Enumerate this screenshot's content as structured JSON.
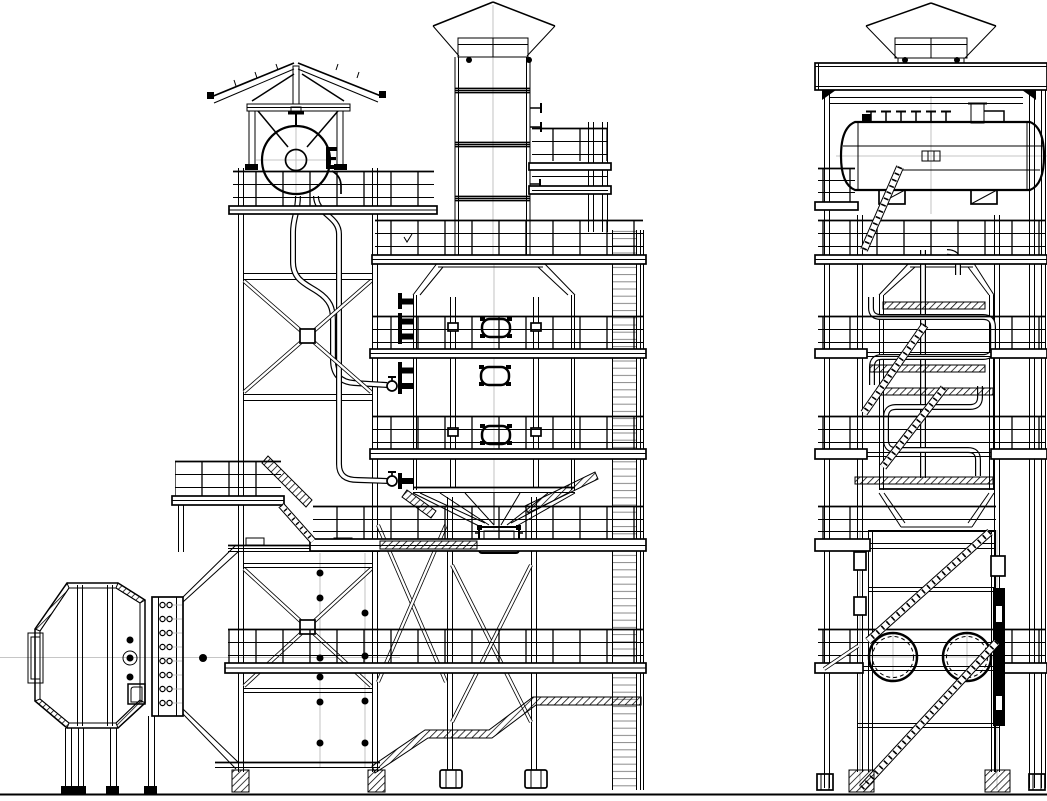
{
  "document": {
    "kind": "technical line drawing",
    "subject": "boiler / flue-gas cleaning tower general arrangement",
    "views": [
      "front elevation",
      "side elevation"
    ],
    "background_color": "#ffffff",
    "line_color": "#000000",
    "centerline_color": "#b4b4b4"
  },
  "front_elevation": {
    "components": [
      "gabled drum shelter with king-post truss",
      "steam drum end view with hatched manway hub",
      "vent stack with conical rain cap and three flanged joints",
      "stack access platform with twin columns",
      "X-braced left support tower",
      "two downcomer pipes with valved wall nozzles",
      "boiler casing with tapered top and lifting lugs",
      "three oval manholes",
      "four plain wall nozzles",
      "ash hopper with ribbed cone and rotary outlet",
      "hopper support columns with X-bracing and base plates",
      "lower flue duct box with X-brace and bolted panels",
      "octagonal duct end with bolted ring flange and access door",
      "expanding transition duct",
      "caged side ladder",
      "five railed platform levels plus mini platform with stair",
      "inclined hatched chute at grade"
    ],
    "manhole_count": 3,
    "flange_bolt_rows": 8,
    "panel_bolt_dots_left_column": 6,
    "panel_bolt_dots_right_column": 4
  },
  "side_elevation": {
    "components": [
      "flat shelter roof slab with capped stack",
      "steam drum side view with dished heads",
      "six top drum nozzles plus tall vent nozzle",
      "drum saddles and sight glass",
      "tapered casing top with lifting lugs",
      "serpentine downcomer piping",
      "four hatched grating strips",
      "zig-zag access stairs (five flights)",
      "two circular duct openings with bolt circles",
      "railed platforms protruding both sides",
      "dark equipment channel on right column",
      "hatched column base plates"
    ],
    "duct_opening_count": 2,
    "drum_top_nozzle_count": 6,
    "stair_flight_count": 5
  },
  "ground": {
    "present": true
  }
}
